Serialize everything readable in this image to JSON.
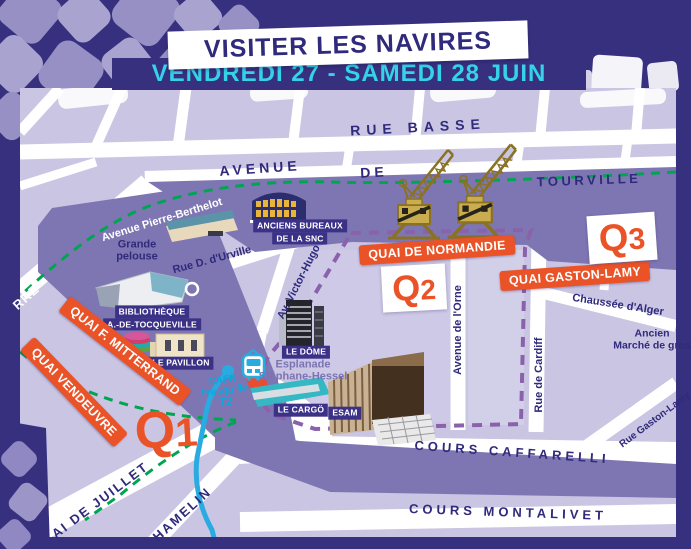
{
  "header": {
    "title": "VISITER LES NAVIRES",
    "dates": "VENDREDI 27 - SAMEDI 28 JUIN"
  },
  "markers": {
    "q1": {
      "letter": "Q",
      "digit": "1"
    },
    "q2": {
      "letter": "Q",
      "digit": "2"
    },
    "q3": {
      "letter": "Q",
      "digit": "3"
    }
  },
  "quay_banners": {
    "normandie": "QUAI DE NORMANDIE",
    "gaston_lamy": "QUAI GASTON-LAMY",
    "mitterrand": "QUAI F. MITTERRAND",
    "vendeuvre": "QUAI VENDEUVRE"
  },
  "streets": {
    "rue_basse": "RUE BASSE",
    "avenue": "AVENUE",
    "de": "DE",
    "tourville": "TOURVILLE",
    "pierre_berthelot": "Avenue Pierre-Berthelot",
    "rue_durville": "Rue D. d'Urville",
    "victor_hugo": "Av. Victor-Hugo",
    "avenue_orne": "Avenue de l'Orne",
    "chaussee_alger": "Chaussée d'Alger",
    "rue_cardiff": "Rue de Cardiff",
    "rue_gaston_lamy": "Rue Gaston-Lamy",
    "cours_caffarelli": "COURS CAFFARELLI",
    "cours_montalivet": "COURS MONTALIVET",
    "quai_juillet": "AI DE JUILLET",
    "hamelin": "HAMELIN",
    "bassin_partial": "RRE"
  },
  "areas": {
    "grande_pelouse": [
      "Grande",
      "pelouse"
    ],
    "esplanade": [
      "Esplanade",
      "Stéphane-Hessel"
    ],
    "marche": [
      "Ancien",
      "Marché de gros"
    ]
  },
  "pois": {
    "snc": [
      "ANCIENS BUREAUX",
      "DE LA SNC"
    ],
    "bibliotheque": [
      "BIBLIOTHÈQUE",
      "A.-DE-TOCQUEVILLE"
    ],
    "pavillon": "LE PAVILLON",
    "dome": "LE DÔME",
    "cargo": "LE CARGÖ",
    "esam": "ESAM"
  },
  "tram": {
    "city": "CAEN",
    "name": "Presqu'île",
    "line": "T2"
  },
  "colors": {
    "background": "#37307f",
    "orange": "#ea5328",
    "cyan": "#35d3e8",
    "map_base": "#c9c5e3",
    "water": "#7e76b2",
    "green_route": "#00a551",
    "purple_route": "#8a62ab",
    "tram_blue": "#29abe2",
    "crane_gold": "#b89b3e"
  }
}
